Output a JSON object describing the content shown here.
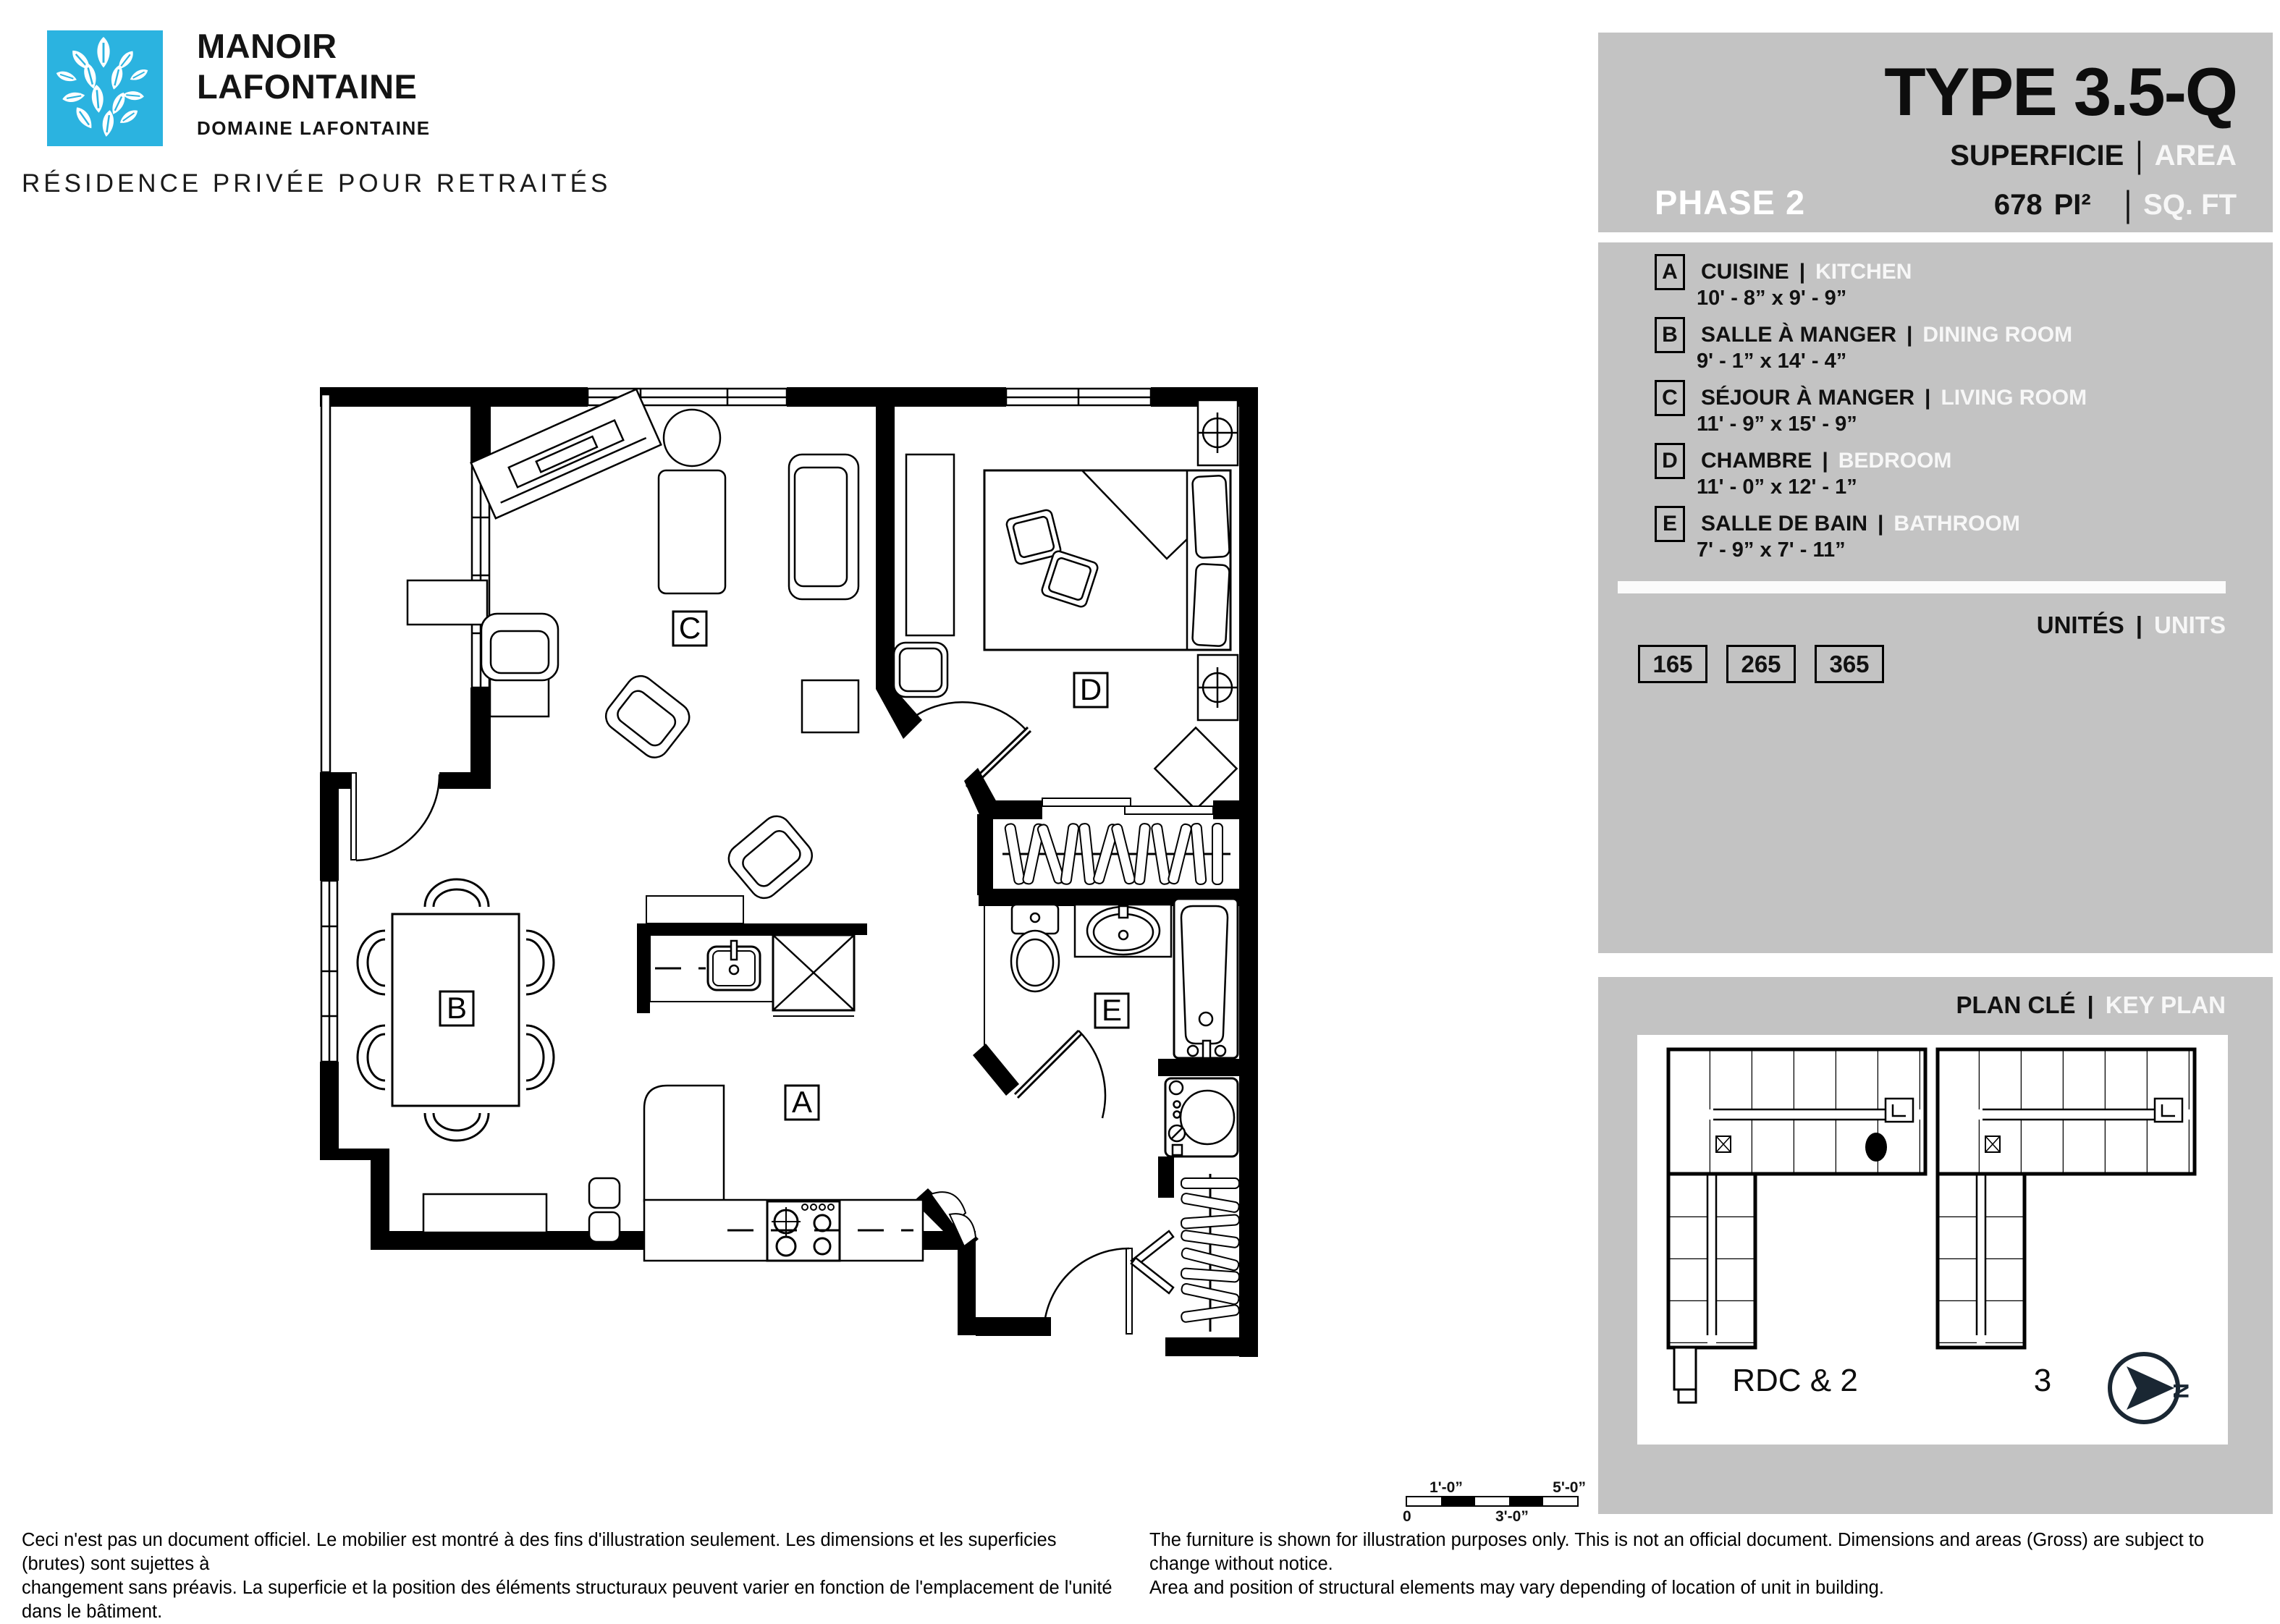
{
  "brand": {
    "name_line1": "MANOIR",
    "name_line2": "LAFONTAINE",
    "subtitle": "DOMAINE LAFONTAINE",
    "tagline": "RÉSIDENCE PRIVÉE POUR RETRAITÉS",
    "logo_color": "#2bb3e0"
  },
  "header": {
    "phase": "PHASE 2",
    "type_title": "TYPE 3.5-Q",
    "area_label_fr": "SUPERFICIE",
    "area_label_en": "AREA",
    "divider": "|",
    "area_value": "678",
    "area_unit_fr": "PI²",
    "area_unit_en": "SQ. FT"
  },
  "legend": {
    "rows": [
      {
        "letter": "A",
        "fr": "CUISINE",
        "en": "KITCHEN",
        "dims": "10' - 8” x 9' - 9”"
      },
      {
        "letter": "B",
        "fr": "SALLE À MANGER",
        "en": "DINING ROOM",
        "dims": "9' - 1” x 14' - 4”"
      },
      {
        "letter": "C",
        "fr": "SÉJOUR À MANGER",
        "en": "LIVING ROOM",
        "dims": "11' - 9” x 15' - 9”"
      },
      {
        "letter": "D",
        "fr": "CHAMBRE",
        "en": "BEDROOM",
        "dims": "11' - 0” x 12' - 1”"
      },
      {
        "letter": "E",
        "fr": "SALLE DE BAIN",
        "en": "BATHROOM",
        "dims": "7' - 9” x 7' - 11”"
      }
    ]
  },
  "units": {
    "label_fr": "UNITÉS",
    "label_en": "UNITS",
    "numbers": [
      "165",
      "265",
      "365"
    ]
  },
  "keyplan": {
    "label_fr": "PLAN CLÉ",
    "label_en": "KEY PLAN",
    "left_building_label": "RDC & 2",
    "right_building_label": "3",
    "north_letter": "N",
    "compass_color": "#1a2733"
  },
  "scalebar": {
    "zero": "0",
    "one_ft": "1'-0”",
    "three_ft": "3'-0”",
    "five_ft": "5'-0”"
  },
  "disclaimer": {
    "fr_line1": "Ceci n'est pas un document officiel. Le mobilier est montré à des fins d'illustration seulement. Les dimensions et les superficies (brutes) sont sujettes à",
    "fr_line2": "changement sans préavis. La superficie et la position des éléments structuraux peuvent varier en fonction de l'emplacement de l'unité dans le bâtiment.",
    "en_line1": "The furniture is shown for illustration purposes only. This is not an official document. Dimensions and areas (Gross) are subject to change without notice.",
    "en_line2": "Area and position of structural elements may vary depending of location of unit in building."
  }
}
